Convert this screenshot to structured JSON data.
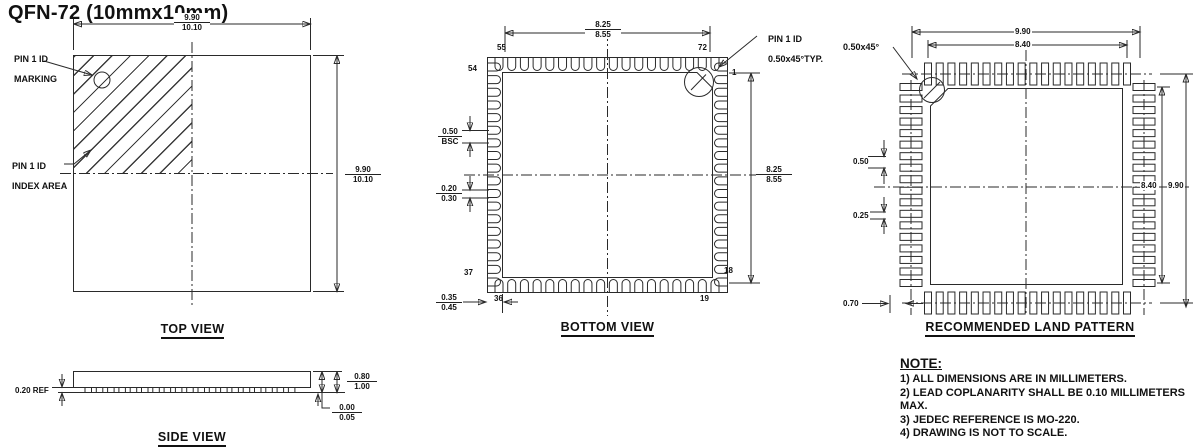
{
  "title": "QFN-72 (10mmx10mm)",
  "colors": {
    "line": "#2a2a2a",
    "text": "#111111",
    "background": "#ffffff"
  },
  "views": {
    "top": {
      "label": "TOP VIEW",
      "callout_pin1_marking": [
        "PIN 1 ID",
        "MARKING"
      ],
      "callout_pin1_index": [
        "PIN 1 ID",
        "INDEX AREA"
      ],
      "dim_width": {
        "min": "9.90",
        "max": "10.10"
      },
      "dim_height": {
        "min": "9.90",
        "max": "10.10"
      }
    },
    "bottom": {
      "label": "BOTTOM VIEW",
      "callout_pin1": [
        "PIN 1 ID",
        "0.50x45°TYP."
      ],
      "dim_span_h": {
        "min": "8.25",
        "max": "8.55"
      },
      "dim_span_v": {
        "min": "8.25",
        "max": "8.55"
      },
      "dim_pitch": {
        "top": "0.50",
        "bot": "BSC"
      },
      "dim_lead_width": {
        "min": "0.20",
        "max": "0.30"
      },
      "dim_lead_length": {
        "min": "0.35",
        "max": "0.45"
      },
      "pins": {
        "p55": "55",
        "p72": "72",
        "p54": "54",
        "p37": "37",
        "p36": "36",
        "p19": "19",
        "p1": "1",
        "p18": "18"
      }
    },
    "land": {
      "label": "RECOMMENDED LAND PATTERN",
      "callout_chamfer": "0.50x45°",
      "dim_outer_w": "9.90",
      "dim_inner_w": "8.40",
      "dim_outer_h": "9.90",
      "dim_inner_h": "8.40",
      "dim_pitch": "0.50",
      "dim_pad_width": "0.25",
      "dim_pad_length": "0.70"
    },
    "side": {
      "label": "SIDE VIEW",
      "dim_standoff": "0.20 REF",
      "dim_body": {
        "min": "0.80",
        "max": "1.00"
      },
      "dim_seating": {
        "min": "0.00",
        "max": "0.05"
      }
    }
  },
  "note": {
    "heading": "NOTE:",
    "items": [
      "1) ALL DIMENSIONS ARE IN MILLIMETERS.",
      "2) LEAD COPLANARITY SHALL BE 0.10 MILLIMETERS MAX.",
      "3) JEDEC REFERENCE IS MO-220.",
      "4) DRAWING IS NOT TO SCALE."
    ]
  }
}
